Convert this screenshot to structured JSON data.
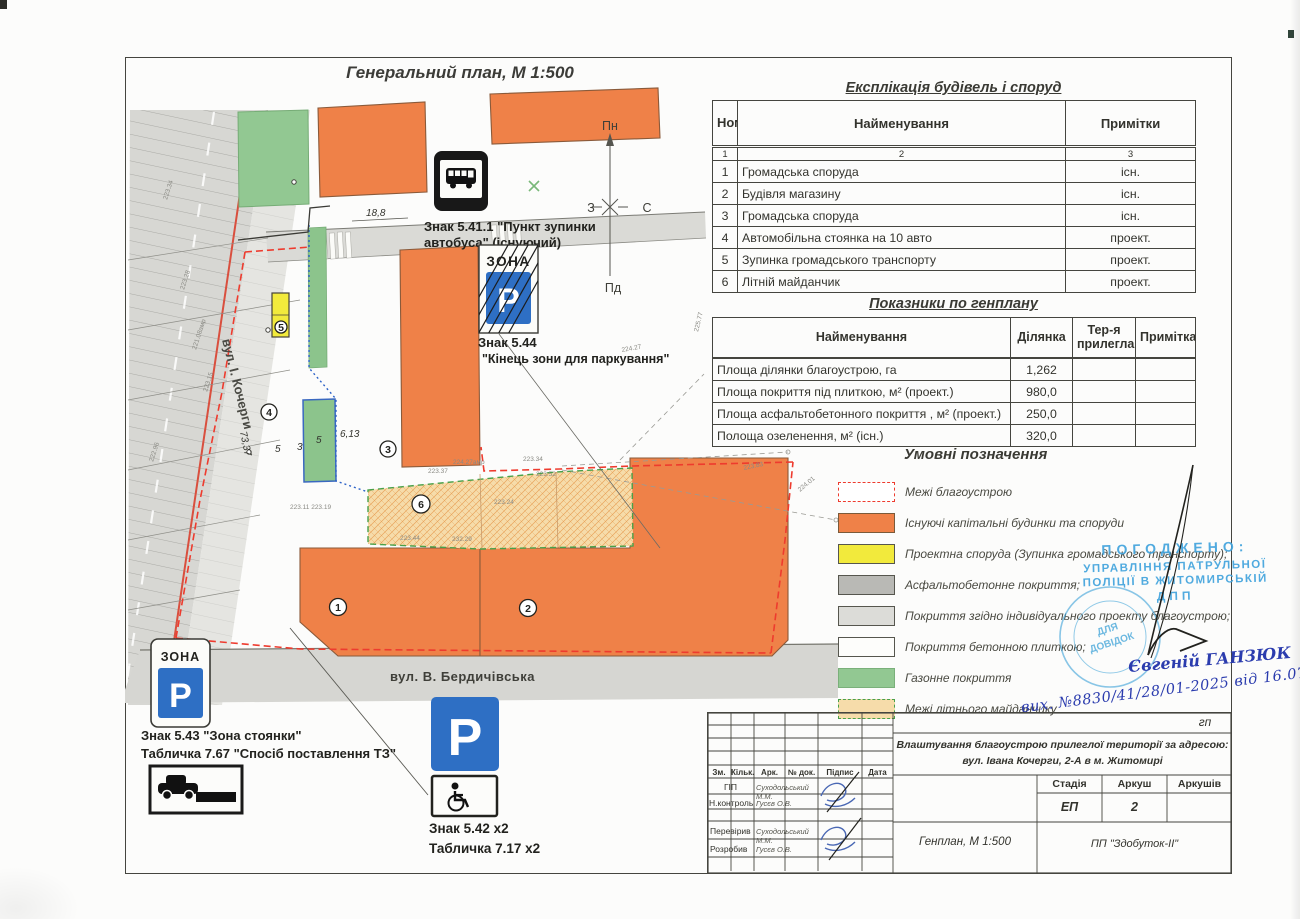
{
  "title": "Генеральний план, М 1:500",
  "explication": {
    "title": "Експлікація будівель і споруд",
    "columns": [
      "Номер по плану",
      "Найменування",
      "Примітки"
    ],
    "column_numbers": [
      "1",
      "2",
      "3"
    ],
    "rows": [
      {
        "num": "1",
        "name": "Громадська споруда",
        "note": "існ."
      },
      {
        "num": "2",
        "name": "Будівля магазину",
        "note": "існ."
      },
      {
        "num": "3",
        "name": "Громадська споруда",
        "note": "існ."
      },
      {
        "num": "4",
        "name": "Автомобільна стоянка на 10 авто",
        "note": "проект."
      },
      {
        "num": "5",
        "name": "Зупинка громадського транспорту",
        "note": "проект."
      },
      {
        "num": "6",
        "name": "Літній майданчик",
        "note": "проект."
      }
    ]
  },
  "indicators": {
    "title": "Показники по генплану",
    "columns": [
      "Найменування",
      "Ділянка",
      "Тер-я прилегла",
      "Примітка"
    ],
    "rows": [
      {
        "name": "Площа ділянки благоустрою, га",
        "value": "1,262"
      },
      {
        "name": "Площа покриття під плиткою, м² (проект.)",
        "value": "980,0"
      },
      {
        "name": "Площа асфальтобетонного покриття , м² (проект.)",
        "value": "250,0"
      },
      {
        "name": "Полоща озеленення,  м² (існ.)",
        "value": "320,0"
      }
    ]
  },
  "legend": {
    "title": "Умовні позначення",
    "items": [
      {
        "label": "Межі благоустрою"
      },
      {
        "label": "Існуючі капітальні будинки та споруди"
      },
      {
        "label": "Проектна споруда (Зупинка громадського транспорту);"
      },
      {
        "label": "Асфальтобетонне покриття;"
      },
      {
        "label": "Покриття згідно індивідуального проекту благоустрою;"
      },
      {
        "label": "Покриття бетонною плиткою;"
      },
      {
        "label": "Газонне покриття"
      },
      {
        "label": "Межі літнього майданчику"
      }
    ]
  },
  "signs": {
    "bus_stop": {
      "line1": "Знак 5.41.1 \"Пункт зупинки",
      "line2": "автобуса\" (існуючий)"
    },
    "zone_end": {
      "zona": "ЗОНА",
      "letter": "P",
      "line1": "Знак 5.44",
      "line2": "\"Кінець зони для паркування\""
    },
    "parking_zone": {
      "zona": "ЗОНА",
      "letter": "P",
      "line1": "Знак 5.43 \"Зона стоянки\"",
      "line2": "Табличка 7.67 \"Спосіб поставлення ТЗ\""
    },
    "parking": {
      "letter": "P",
      "line1": "Знак 5.42 х2",
      "line2": "Табличка 7.17 х2"
    }
  },
  "compass": {
    "n": "Пн",
    "s": "Пд",
    "w": "З",
    "e": "С"
  },
  "streets": {
    "kocherhy": "вул. І. Кочерги",
    "berdychivska": "вул. В. Бердичівська"
  },
  "map": {
    "annotations": [
      {
        "t": "18,8",
        "tf": "translate(366 216)",
        "cls": "dim"
      },
      {
        "t": "6,13",
        "tf": "translate(340 437)",
        "cls": "dim"
      },
      {
        "t": "5",
        "tf": "translate(275 452)",
        "cls": "dim"
      },
      {
        "t": "3",
        "tf": "translate(297 450)",
        "cls": "dim"
      },
      {
        "t": "5",
        "tf": "translate(316 443)",
        "cls": "dim"
      },
      {
        "t": "73,37",
        "tf": "translate(240 432) rotate(78)",
        "cls": "dim"
      },
      {
        "t": "223.34",
        "tf": "translate(167 200) rotate(-72)",
        "cls": "ann"
      },
      {
        "t": "223.28",
        "tf": "translate(184 290) rotate(-72)",
        "cls": "ann"
      },
      {
        "t": "221.08амр",
        "tf": "translate(196 350) rotate(-72)",
        "cls": "ann"
      },
      {
        "t": "223.15",
        "tf": "translate(207 392) rotate(-72)",
        "cls": "ann"
      },
      {
        "t": "222.96",
        "tf": "translate(153 462) rotate(-72)",
        "cls": "ann"
      },
      {
        "t": "223.37",
        "tf": "translate(428 473)",
        "cls": "ann"
      },
      {
        "t": "224.27амр",
        "tf": "translate(453 464)",
        "cls": "ann"
      },
      {
        "t": "223.34",
        "tf": "translate(523 461)",
        "cls": "ann"
      },
      {
        "t": "223.52",
        "tf": "translate(536 476)",
        "cls": "ann"
      },
      {
        "t": "223.24",
        "tf": "translate(494 504)",
        "cls": "ann"
      },
      {
        "t": "223.44",
        "tf": "translate(400 540)",
        "cls": "ann"
      },
      {
        "t": "232.29",
        "tf": "translate(452 541)",
        "cls": "ann"
      },
      {
        "t": "223.11 223.19",
        "tf": "translate(290 509)",
        "cls": "ann"
      },
      {
        "t": "224.27",
        "tf": "translate(622 352) rotate(-10)",
        "cls": "ann"
      },
      {
        "t": "223.83",
        "tf": "translate(744 470) rotate(-12)",
        "cls": "ann"
      },
      {
        "t": "224.01",
        "tf": "translate(800 492) rotate(-40)",
        "cls": "ann"
      },
      {
        "t": "225.77",
        "tf": "translate(698 332) rotate(-76)",
        "cls": "ann"
      }
    ],
    "numbers": [
      {
        "n": "1",
        "tf": "translate(338 607)",
        "r": "8.5"
      },
      {
        "n": "2",
        "tf": "translate(528 608)",
        "r": "8.5"
      },
      {
        "n": "3",
        "tf": "translate(388 449)",
        "r": "8"
      },
      {
        "n": "4",
        "tf": "translate(269 412)",
        "r": "8"
      },
      {
        "n": "5",
        "tf": "translate(281 327)",
        "r": "6"
      },
      {
        "n": "6",
        "tf": "translate(421 504)",
        "r": "9"
      }
    ]
  },
  "stamp": {
    "approved": "ПОГОДЖЕНО:",
    "org1": "УПРАВЛІННЯ ПАТРУЛЬНОЇ",
    "org2": "ПОЛІЦІЇ В ЖИТОМИРСЬКІЙ",
    "org3": "ДПП",
    "round1": "ДЛЯ",
    "round2": "ДОВІДОК"
  },
  "handwriting": {
    "signature": "Євгеній ГАНЗЮК",
    "reference": "вих. №8830/41/28/01-2025 від 16.07.2025"
  },
  "titleblock": {
    "corner_code": "гп",
    "project1": "Влаштування благоустрою прилеглої території за адресою:",
    "project2": "вул. Івана Кочерги, 2-А в м. Житомирі",
    "rev_cols": [
      "Зм.",
      "Кільк.",
      "Арк.",
      "№ док.",
      "Підпис",
      "Дата"
    ],
    "roles": [
      {
        "role": "ГІП",
        "name": "Суходольський М.М."
      },
      {
        "role": "Н.контроль",
        "name": "Гусєв О.В."
      },
      {
        "role": "Перевірив",
        "name": "Суходольський М.М."
      },
      {
        "role": "Розробив",
        "name": "Гусєв О.В."
      }
    ],
    "stage_cols": [
      "Стадія",
      "Аркуш",
      "Аркушів"
    ],
    "stage": "ЕП",
    "sheet": "2",
    "sheets_total": "",
    "doc_title": "Генплан, М 1:500",
    "company": "ПП \"Здобуток-ІІ\""
  },
  "colors": {
    "building_existing": "#ef8148",
    "proposed_structure": "#f2ea3c",
    "lawn": "#92c892",
    "asphalt": "#b9b9b5",
    "paving": "#dcdcd8",
    "summer_terrace": "#f6dcaa",
    "boundary_red": "#ee3b2e",
    "sign_blue": "#2e6fc4",
    "stamp_blue": "#42a4dd",
    "ink_blue": "#2b3cae"
  }
}
